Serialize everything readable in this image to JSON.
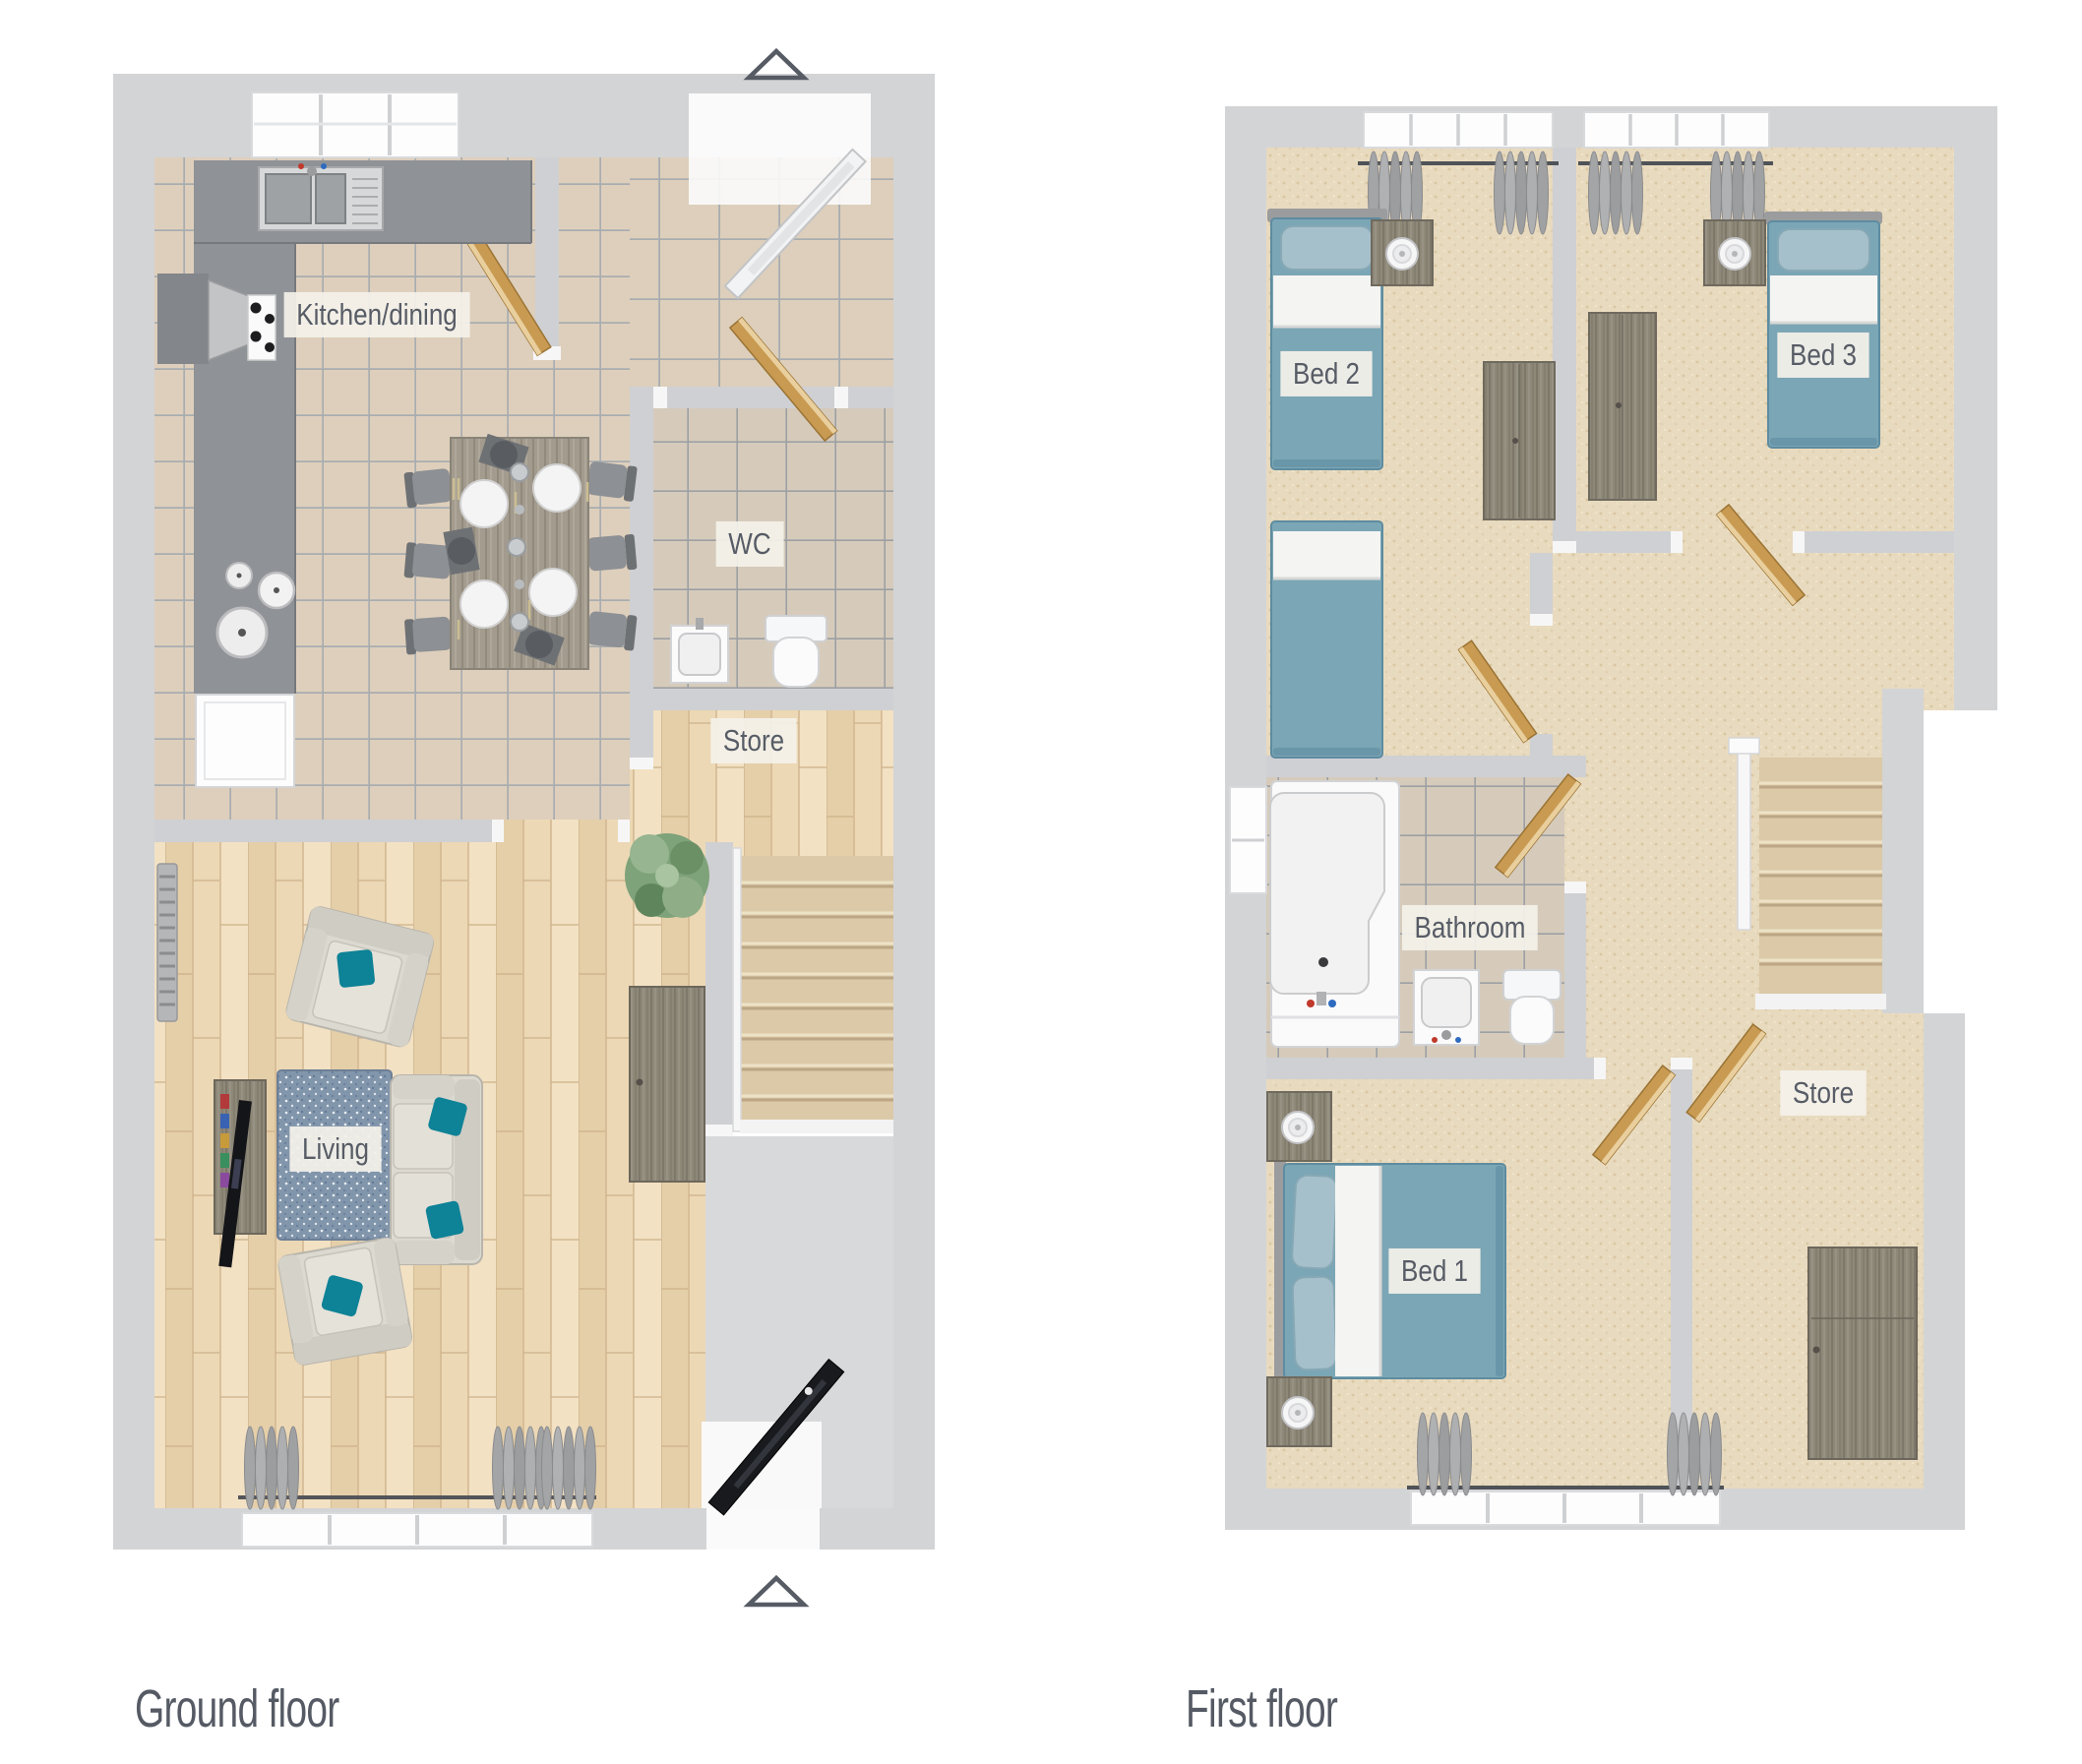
{
  "page": {
    "background_color": "#ffffff",
    "type": "estate-agent-floorplan"
  },
  "ground_floor": {
    "caption": "Ground floor",
    "room_labels": {
      "kitchen_dining": "Kitchen/dining",
      "wc": "WC",
      "store": "Store",
      "living": "Living"
    }
  },
  "first_floor": {
    "caption": "First floor",
    "room_labels": {
      "bed2": "Bed 2",
      "bed3": "Bed 3",
      "bathroom": "Bathroom",
      "bed1": "Bed 1",
      "store": "Store"
    }
  },
  "icons": {
    "entrance_arrow": "△"
  },
  "markers": {
    "entrance_arrow_count": 2
  },
  "colors": {
    "wall": "#d3d4d6",
    "floor_wood": "#ecd8b5",
    "floor_tile": "#decfbc",
    "floor_carpet": "#e8dabe",
    "stair_carpet": "#dbc9a7",
    "bed_teal": "#7ba6b5",
    "pillow_teal": "#0e8296",
    "door_wood": "#c89a52",
    "label_bg": "#f3f0e9",
    "label_text": "#575c66",
    "caption_text": "#555a64"
  }
}
